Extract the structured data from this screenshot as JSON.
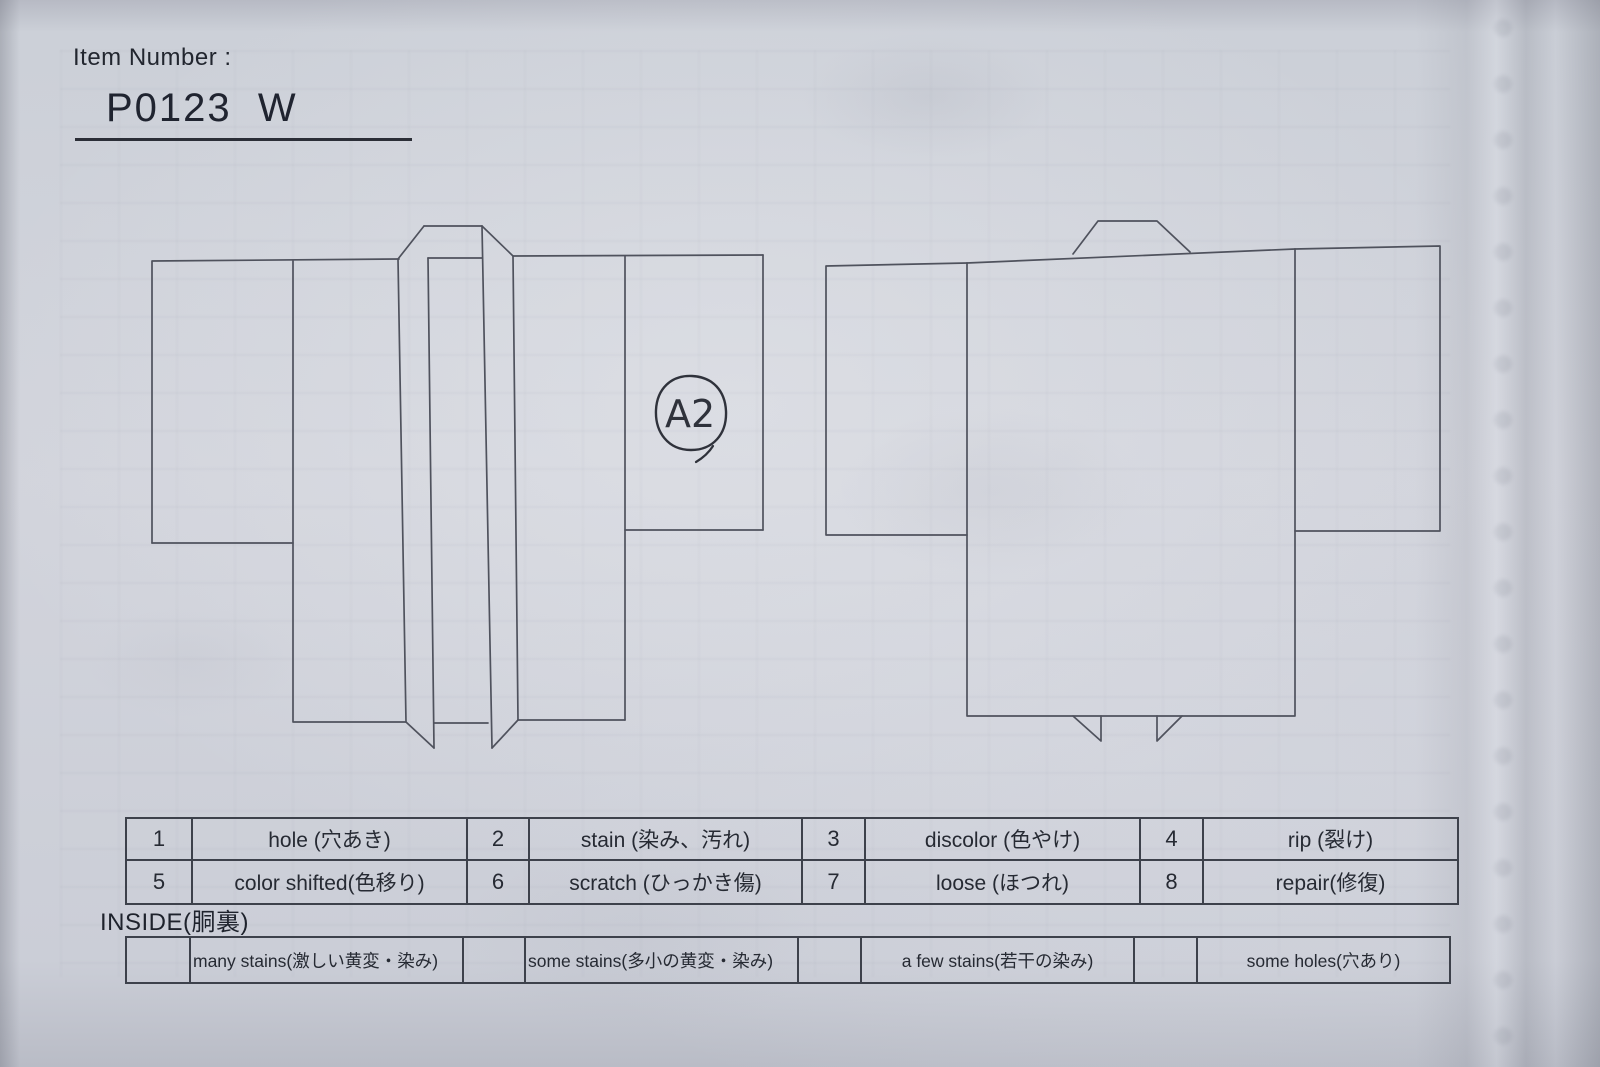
{
  "header": {
    "item_number_label": "Item Number :",
    "item_number_value": "P0123  W"
  },
  "annotation": {
    "label": "A2"
  },
  "defect_codes": [
    {
      "code": "1",
      "label": "hole (穴あき)"
    },
    {
      "code": "2",
      "label": "stain (染み、汚れ)"
    },
    {
      "code": "3",
      "label": "discolor (色やけ)"
    },
    {
      "code": "4",
      "label": "rip (裂け)"
    },
    {
      "code": "5",
      "label": "color shifted(色移り)"
    },
    {
      "code": "6",
      "label": "scratch (ひっかき傷)"
    },
    {
      "code": "7",
      "label": "loose (ほつれ)"
    },
    {
      "code": "8",
      "label": "repair(修復)"
    }
  ],
  "inside": {
    "heading": "INSIDE(胴裏)",
    "conditions": [
      "many stains(激しい黄変・染み)",
      "some stains(多小の黄変・染み)",
      "a few stains(若干の染み)",
      "some holes(穴あり)"
    ]
  },
  "colors": {
    "paper": "#d0d3db",
    "ink": "#262a33",
    "diagram_line": "#4f525d",
    "pen": "#2f323b"
  }
}
